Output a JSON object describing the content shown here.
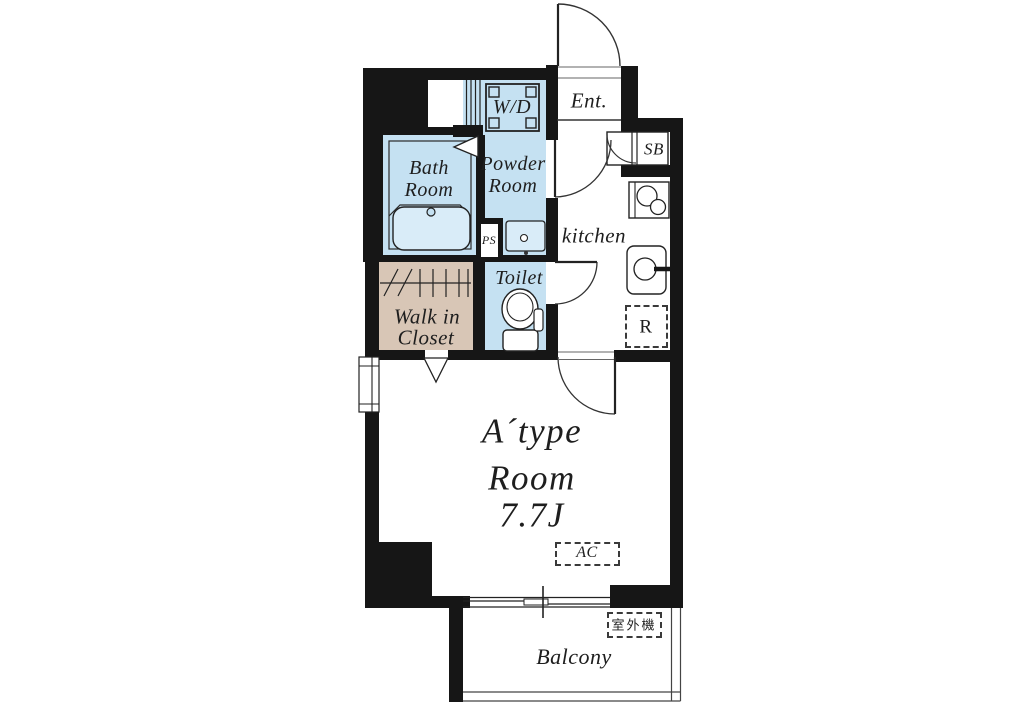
{
  "colors": {
    "wall": "#161616",
    "wet_area_fill": "#c5e1f2",
    "fixture_fill": "#d9ecf8",
    "closet_fill": "#d8c6b6",
    "line": "#2a2a2a"
  },
  "labels": {
    "ent": "Ent.",
    "wd": "W/D",
    "sb": "SB",
    "bath1": "Bath",
    "bath2": "Room",
    "powder1": "Powder",
    "powder2": "Room",
    "kitchen": "kitchen",
    "ps": "PS",
    "toilet": "Toilet",
    "wic1": "Walk in",
    "wic2": "Closet",
    "fridge": "R",
    "type": "A´type",
    "room": "Room",
    "size": "7.7J",
    "ac": "AC",
    "outdoor": "室外機",
    "balcony": "Balcony"
  }
}
